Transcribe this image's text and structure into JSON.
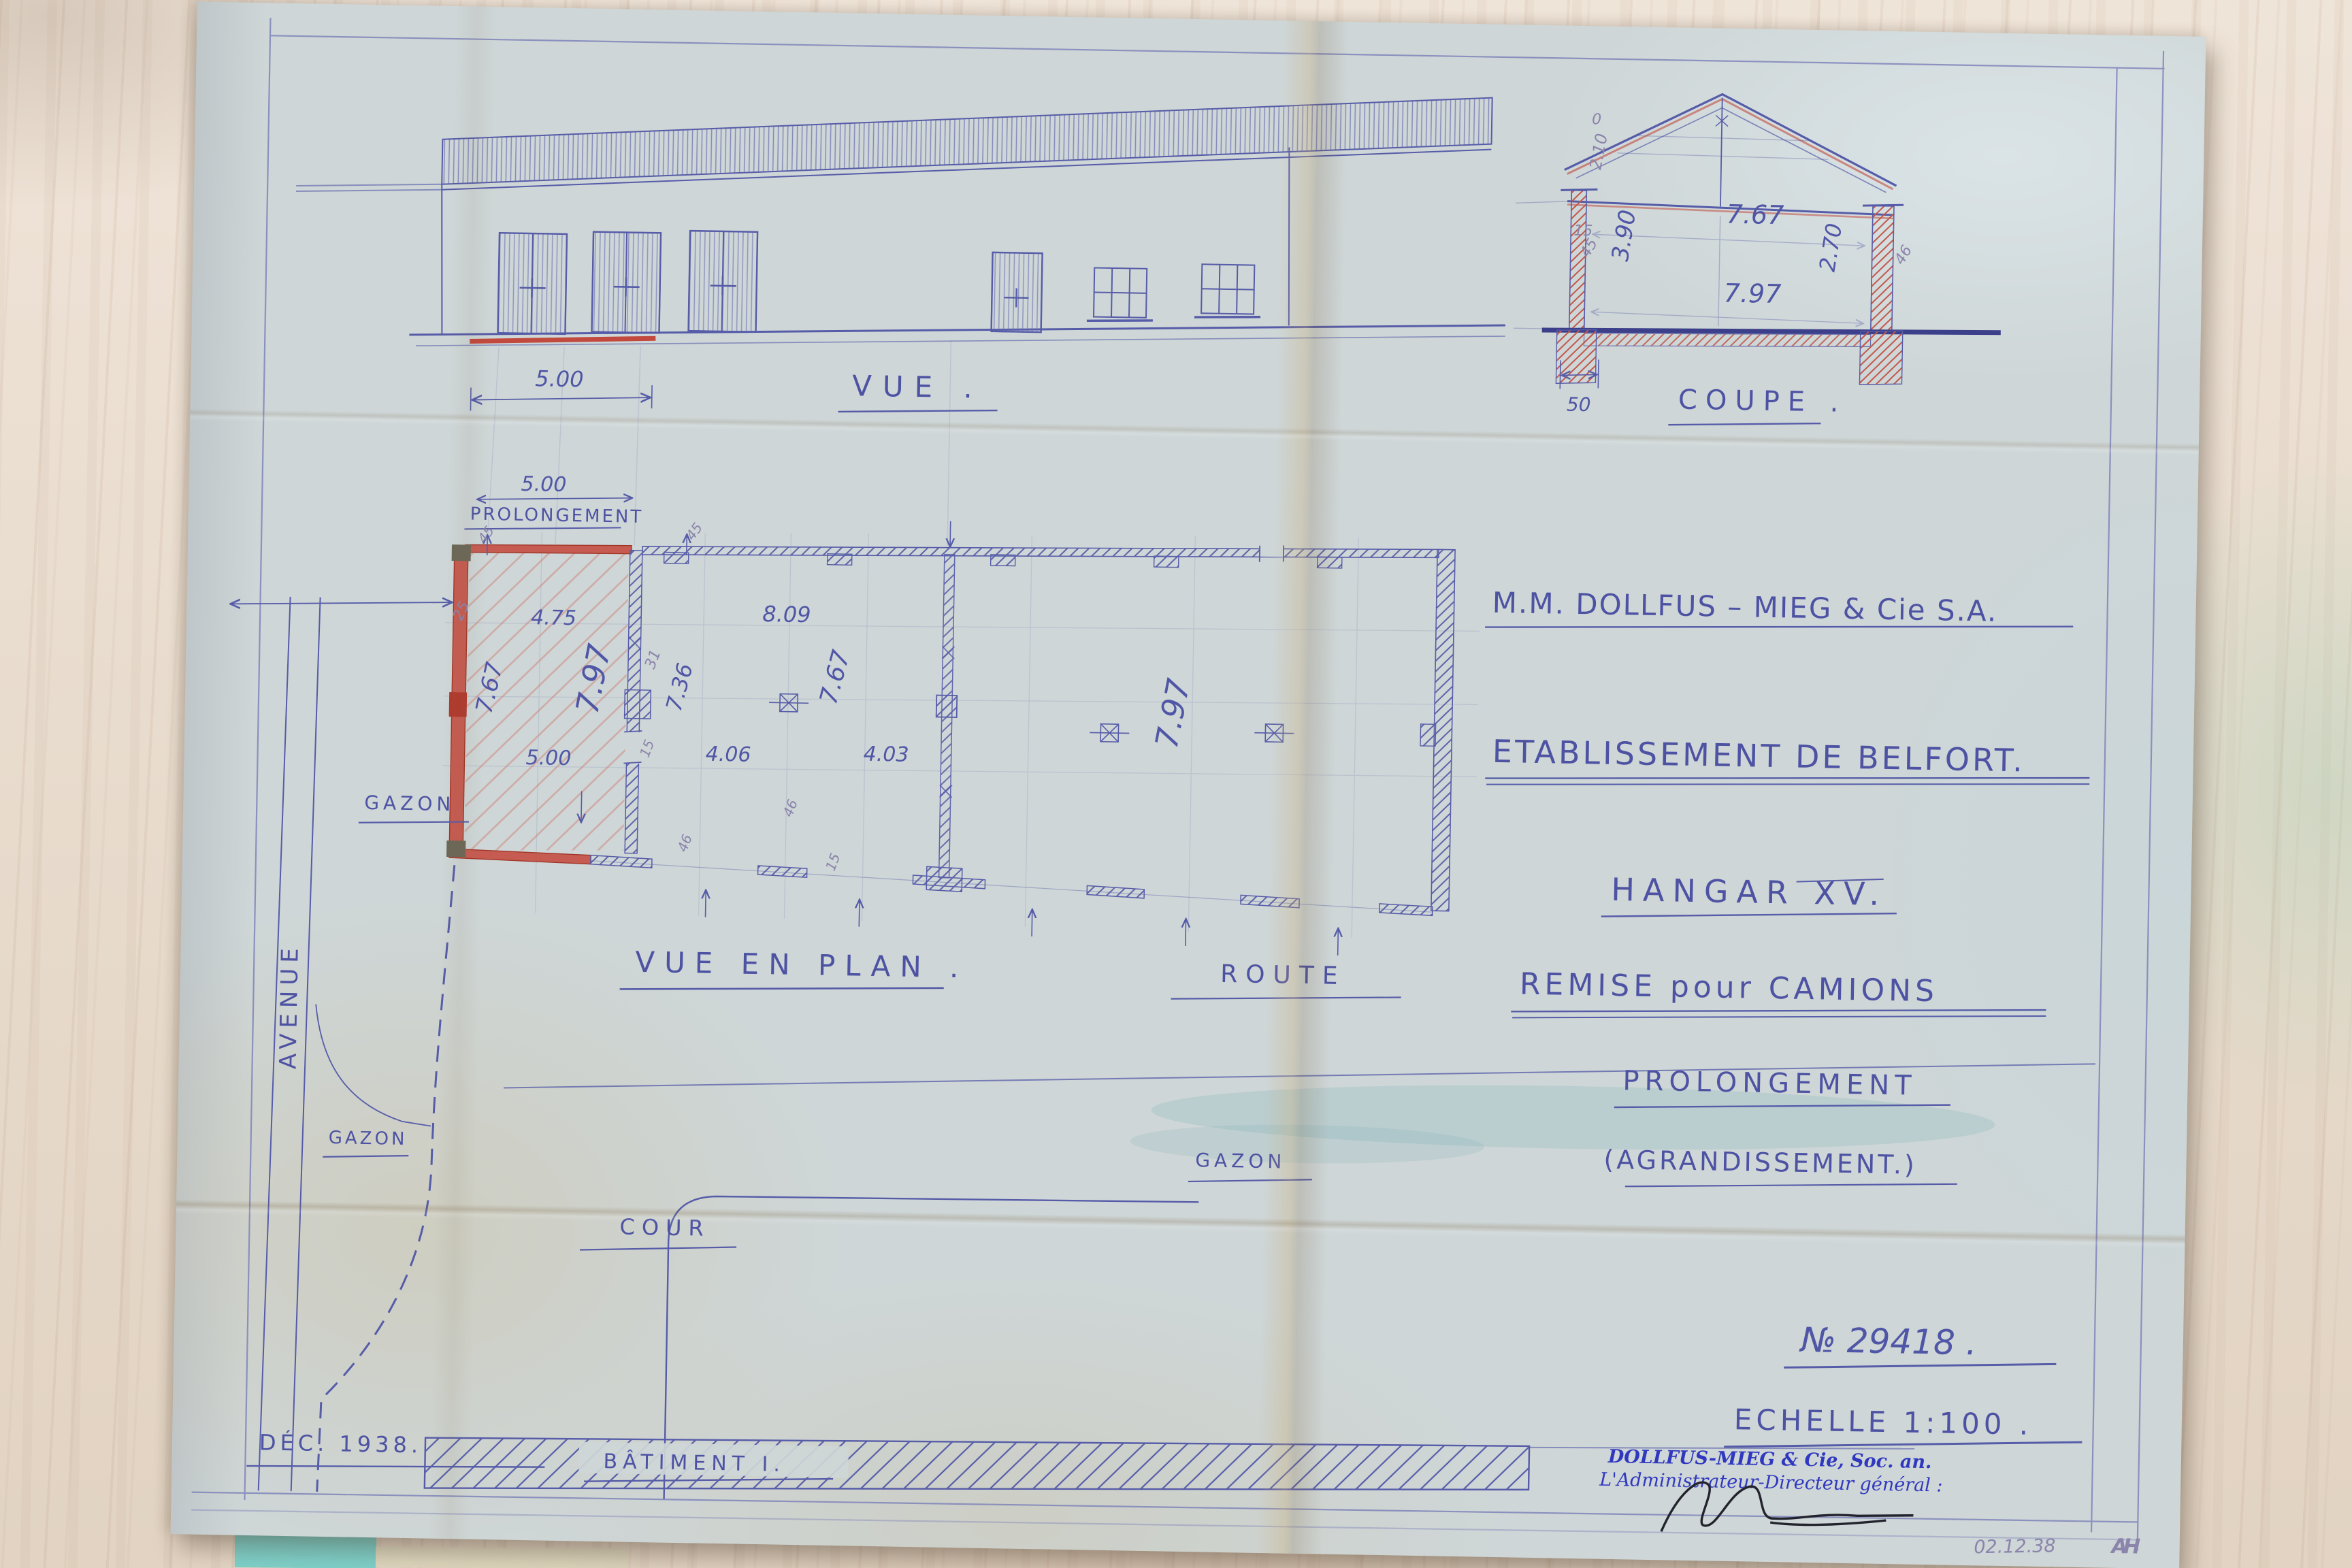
{
  "title_block": {
    "company": "M.M. DOLLFUS – MIEG & Cie S.A.",
    "establishment": "ETABLISSEMENT DE BELFORT.",
    "project": "HANGAR XV.",
    "subtitle": "REMISE pour CAMIONS",
    "extension": "PROLONGEMENT",
    "extension_note": "(AGRANDISSEMENT.)"
  },
  "views": {
    "elevation_label": "VUE .",
    "section_label": "COUPE .",
    "plan_label": "VUE EN PLAN ."
  },
  "site": {
    "gazon_left": "GAZON",
    "avenue": "AVENUE",
    "gazon_bottom": "GAZON",
    "cour": "COUR",
    "route": "ROUTE",
    "gazon_right": "GAZON",
    "batiment": "BÂTIMENT I.",
    "date_note": "DÉC. 1938."
  },
  "elevation": {
    "dims": {
      "bay": "5.00"
    }
  },
  "plan": {
    "prolongement_label": "PROLONGEMENT",
    "dims": {
      "top_width": "5.00",
      "wall_thickness": "25",
      "inner_width": "4.75",
      "depth_left": "7.67",
      "depth_mid": "7.97",
      "width_mid": "5.00",
      "old_wall": "31",
      "depth_old": "7.36",
      "tick_15": "15",
      "hall_width": "8.09",
      "hall_depth": "7.67",
      "bay_a": "4.06",
      "bay_b": "4.03",
      "tick_46a": "46",
      "tick_46b": "46",
      "tick_15b": "15",
      "tick_45a": "45",
      "tick_45b": "45",
      "right_depth": "7.97"
    }
  },
  "section": {
    "dims": {
      "width_top": "7.67",
      "width_bottom": "7.97",
      "height_wall": "3.90",
      "height_clear": "2.70",
      "rise_zero": "0",
      "rise": "2.10",
      "tick_15": "15",
      "tick_45": "45",
      "tick_46": "46",
      "footing": "50"
    }
  },
  "doc": {
    "number": "№ 29418 .",
    "scale": "ECHELLE 1:100 .",
    "stamp_line1": "DOLLFUS-MIEG & Cie, Soc. an.",
    "stamp_line2": "L'Administrateur-Directeur général :",
    "pencil_date": "02.12.38",
    "pencil_initials": "AH"
  },
  "colors": {
    "paper": "#ced6d7",
    "ink": "#565ca8",
    "red": "#c03a2c",
    "stamp_blue": "#3038c0",
    "signature": "#23232e",
    "teal_card": "#7ed0c9"
  }
}
